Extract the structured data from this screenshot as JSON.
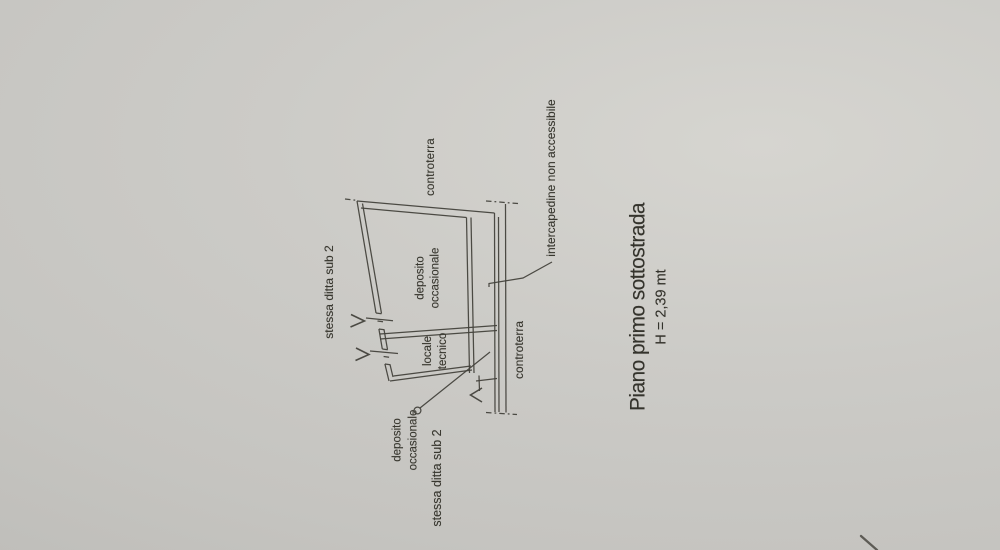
{
  "title_block": {
    "title": "Piano primo sottostrada",
    "height": "H = 2,39 mt"
  },
  "labels": {
    "controterra_top": "controterra",
    "controterra_right": "controterra",
    "stessa_ditta_top_left": "stessa ditta sub 2",
    "stessa_ditta_bottom": "stessa ditta sub 2",
    "intercapedine": "intercapedine non accessibile"
  },
  "rooms": {
    "deposito_occasionale": {
      "line1": "deposito",
      "line2": "occasionale"
    },
    "locale_tecnico": {
      "line1": "locale",
      "line2": "tecnico"
    },
    "deposito_occasionale_bottom": {
      "line1": "deposito",
      "line2": "occasionale"
    }
  },
  "colors": {
    "paper": "#c9c8c4",
    "paper_light": "#d6d5d0",
    "paper_dark": "#bdbcb8",
    "ink": "#43423c"
  },
  "plan": {
    "wall_lines": [
      [
        357,
        201,
        494.5,
        213
      ],
      [
        361,
        208,
        466.5,
        217.5
      ],
      [
        357,
        201,
        376,
        313
      ],
      [
        378.9,
        329,
        382.3,
        349
      ],
      [
        384.9,
        364,
        389,
        381
      ],
      [
        362.5,
        203.5,
        381.5,
        313.5
      ],
      [
        384,
        329.5,
        387.5,
        349.5
      ],
      [
        390,
        364.5,
        393,
        377
      ],
      [
        376,
        313,
        381.5,
        313.8
      ],
      [
        378.9,
        329,
        384.4,
        329.8
      ],
      [
        382.3,
        349,
        387.8,
        349.8
      ],
      [
        384.9,
        364,
        390.4,
        364.8
      ],
      [
        377.5,
        321,
        383,
        321.8
      ],
      [
        383.6,
        356.5,
        389.1,
        357.3
      ],
      [
        366,
        318,
        393,
        320.7
      ],
      [
        370,
        351,
        398,
        353.5
      ],
      [
        380,
        334,
        497,
        325.5
      ],
      [
        380,
        339,
        497,
        330.5
      ],
      [
        466.5,
        217.5,
        469.5,
        373
      ],
      [
        471,
        217.5,
        474,
        373
      ],
      [
        390,
        381,
        472,
        370
      ],
      [
        393.5,
        376,
        471,
        366
      ],
      [
        476,
        381,
        497,
        378.5
      ],
      [
        479,
        375.5,
        479.5,
        391
      ],
      [
        494.5,
        213,
        495,
        412
      ],
      [
        498.5,
        217,
        499,
        412
      ],
      [
        505.5,
        204,
        506,
        412.5
      ]
    ],
    "dashed_lines": [
      [
        345,
        199,
        358,
        200.5
      ],
      [
        486,
        201,
        518,
        203.5
      ],
      [
        486,
        412.5,
        517,
        414.5
      ]
    ],
    "door_arrows": [
      "351,314.5 364.5,321 350.5,327",
      "356,348 369,354.5 355.5,360.5",
      "482,388 470.5,395 482,402"
    ],
    "leader_polylines": [
      "552,262 523,278 489,283.5 489,287",
      "420,408 490,352"
    ],
    "leader_circle": [
      417.5,
      410.5,
      3.4
    ]
  },
  "marks": {
    "bottom_right_scratch": [
      861,
      536,
      877,
      550
    ]
  }
}
